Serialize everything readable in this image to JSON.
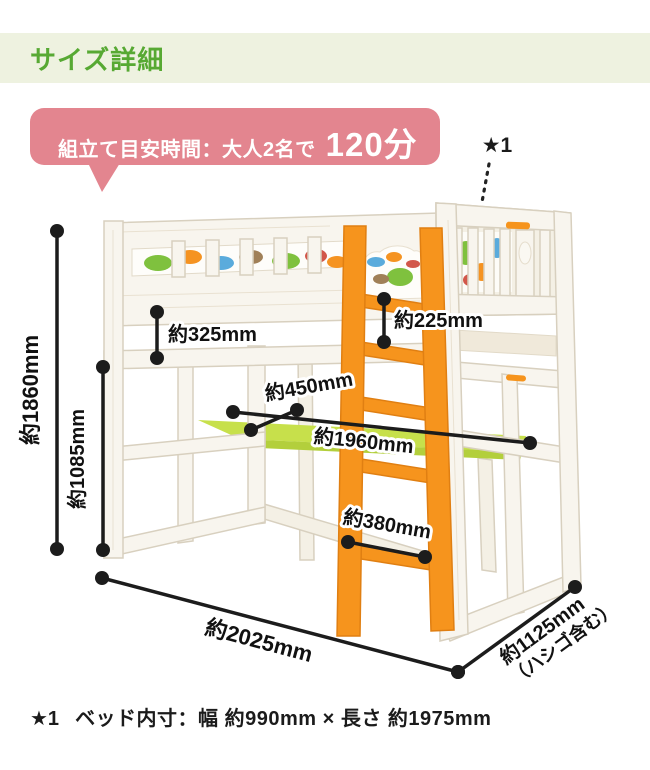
{
  "header": {
    "title": "サイズ詳細"
  },
  "assembly_note": {
    "label": "組立て目安時間：大人2名で",
    "time": "120分"
  },
  "bed_note_marker": "★1",
  "dimensions": {
    "total_height": "約1860mm",
    "under_bed_height": "約1085mm",
    "rail_to_frame_gap": "約325mm",
    "bed_to_rung_gap": "約225mm",
    "desk_depth": "約450mm",
    "desk_length": "約1960mm",
    "ladder_width": "約380mm",
    "total_length": "約2025mm",
    "total_width": "約1125mm",
    "total_width_note": "（ハシゴ含む）"
  },
  "footnote": {
    "marker": "★1",
    "text": "ベッド内寸：幅 約990mm × 長さ 約1975mm"
  },
  "colors": {
    "header_bg": "#eef2e0",
    "accent_green": "#57a933",
    "bubble_pink": "#e3858f",
    "ladder_orange": "#f6941d",
    "desk_green": "#c7e04b",
    "dimension_black": "#1c1c1c"
  }
}
